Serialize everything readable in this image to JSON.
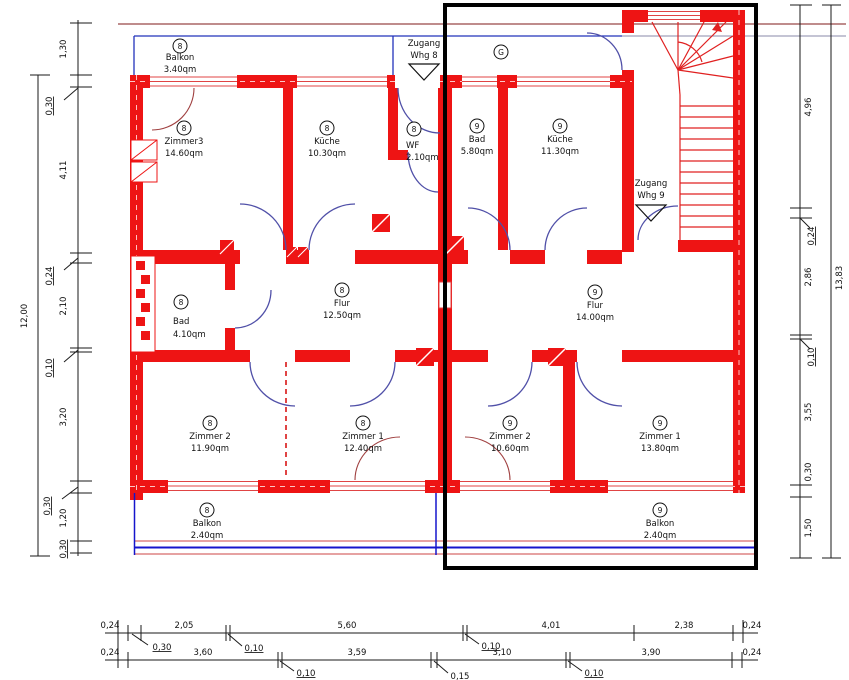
{
  "colors": {
    "wall": "#ee1414",
    "door_arc": "#5050a8",
    "balcony_door_arc": "#a04040",
    "balcony_rail": "#1515cc",
    "apartment9_outline": "#000000",
    "dimension_lines": "#1a1a1a"
  },
  "plan": {
    "corridor_label": "G",
    "access8": {
      "line1": "Zugang",
      "line2": "Whg 8"
    },
    "access9": {
      "line1": "Zugang",
      "line2": "Whg 9"
    },
    "rooms": {
      "balkon8top": {
        "unit": "8",
        "name": "Balkon",
        "area": "3.40qm"
      },
      "zimmer3_8": {
        "unit": "8",
        "name": "Zimmer3",
        "area": "14.60qm"
      },
      "kueche8": {
        "unit": "8",
        "name": "Küche",
        "area": "10.30qm"
      },
      "wf8": {
        "unit": "8",
        "name": "WF",
        "area": "2.10qm"
      },
      "bad9": {
        "unit": "9",
        "name": "Bad",
        "area": "5.80qm"
      },
      "kueche9": {
        "unit": "9",
        "name": "Küche",
        "area": "11.30qm"
      },
      "bad8": {
        "unit": "8",
        "name": "Bad",
        "area": "4.10qm"
      },
      "flur8": {
        "unit": "8",
        "name": "Flur",
        "area": "12.50qm"
      },
      "flur9": {
        "unit": "9",
        "name": "Flur",
        "area": "14.00qm"
      },
      "zimmer2_8": {
        "unit": "8",
        "name": "Zimmer 2",
        "area": "11.90qm"
      },
      "zimmer1_8": {
        "unit": "8",
        "name": "Zimmer 1",
        "area": "12.40qm"
      },
      "zimmer2_9": {
        "unit": "9",
        "name": "Zimmer 2",
        "area": "10.60qm"
      },
      "zimmer1_9": {
        "unit": "9",
        "name": "Zimmer 1",
        "area": "13.80qm"
      },
      "balkon8bottom": {
        "unit": "8",
        "name": "Balkon",
        "area": "2.40qm"
      },
      "balkon9bottom": {
        "unit": "9",
        "name": "Balkon",
        "area": "2.40qm"
      }
    },
    "dimensions": {
      "left": {
        "segments": [
          "1,30",
          "0,30",
          "4,11",
          "0,24",
          "2,10",
          "0,10",
          "3,20",
          "0,30",
          "1,20",
          "0,30"
        ],
        "total": "12,00"
      },
      "right": {
        "segments": [
          "4,96",
          "0,24",
          "2,86",
          "0,10",
          "3,55",
          "0,30",
          "1,50"
        ],
        "total": "13,83"
      },
      "bottom_row1": [
        "0,24",
        "0,30",
        "2,05",
        "0,10",
        "5,60",
        "0,10",
        "4,01",
        "2,38",
        "0,24"
      ],
      "bottom_row2": [
        "0,24",
        "3,60",
        "0,10",
        "3,59",
        "0,15",
        "3,10",
        "0,10",
        "3,90",
        "0,24"
      ]
    }
  }
}
